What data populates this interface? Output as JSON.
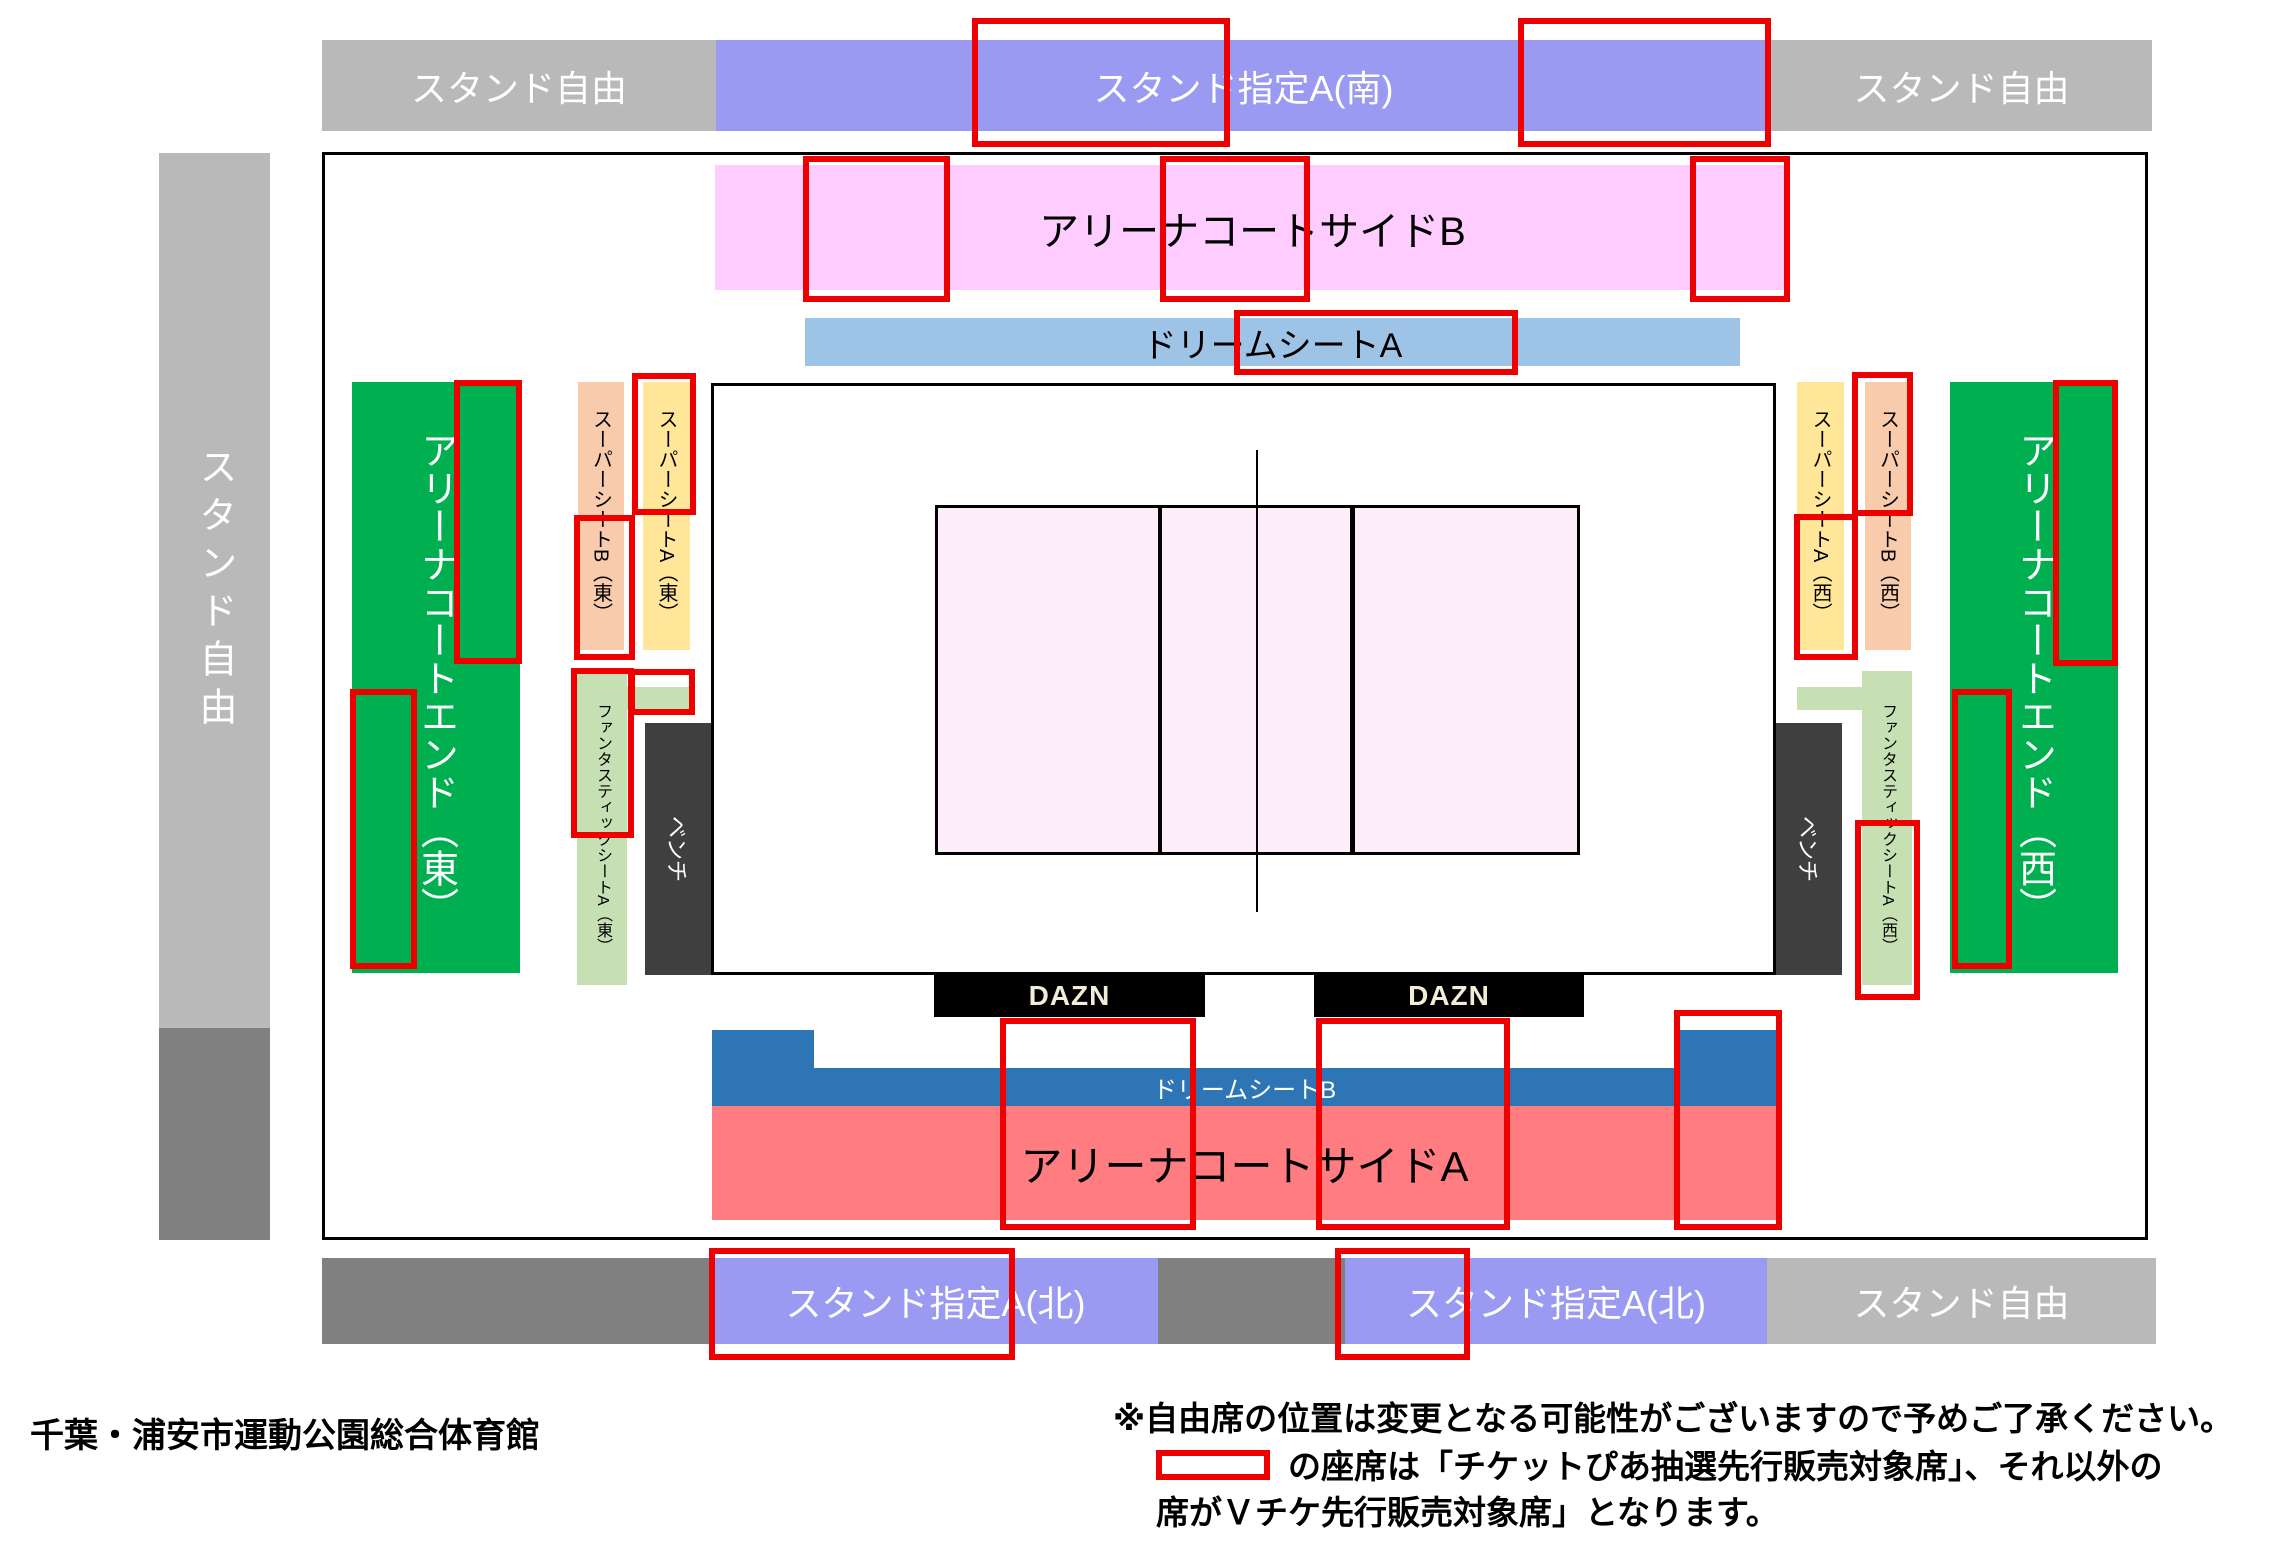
{
  "venue": "千葉・浦安市運動公園総合体育館",
  "areas": {
    "stand_free": "スタンド自由",
    "stand_reserved_south": "スタンド指定А(南)",
    "stand_reserved_north": "スタンド指定А(北)",
    "arena_court_side_b": "アリーナコートサイドB",
    "dream_seat_a": "ドリームシートA",
    "dream_seat_b": "ドリームシートB",
    "arena_court_side_a": "アリーナコートサイドA",
    "arena_court_end_east": "アリーナコートエンド（東）",
    "arena_court_end_west": "アリーナコートエンド（西）",
    "super_seat_b_east": "スーパーシートB（東）",
    "super_seat_a_east": "スーパーシートA（東）",
    "super_seat_a_west": "スーパーシートA（西）",
    "super_seat_b_west": "スーパーシートB（西）",
    "fantastic_seat_a_east": "ファンタスティックシートA（東）",
    "fantastic_seat_a_west": "ファンタスティックシートA（西）",
    "bench": "ベンチ",
    "dazn": "DAZN"
  },
  "legend": {
    "line1": "※自由席の位置は変更となる可能性がございますので予めご了承ください。",
    "line2": "の座席は「チケットぴあ抽選先行販売対象席」、それ以外の",
    "line3": "席がＶチケ先行販売対象席」となります。"
  },
  "colors": {
    "gray_light": "#b9b9b9",
    "gray_dark": "#808080",
    "purple": "#9a9af2",
    "pink": "#ffccff",
    "blue_light": "#9dc3e6",
    "blue_dark": "#2e75b6",
    "salmon": "#ff7c80",
    "green": "#00b050",
    "peach": "#f8cbad",
    "yellow": "#ffe699",
    "green_light": "#c6e0b4",
    "bench": "#3f3f3f",
    "red_outline": "#ee0000",
    "court": "#fdeefa",
    "dazn_text": "#f2edd7"
  }
}
